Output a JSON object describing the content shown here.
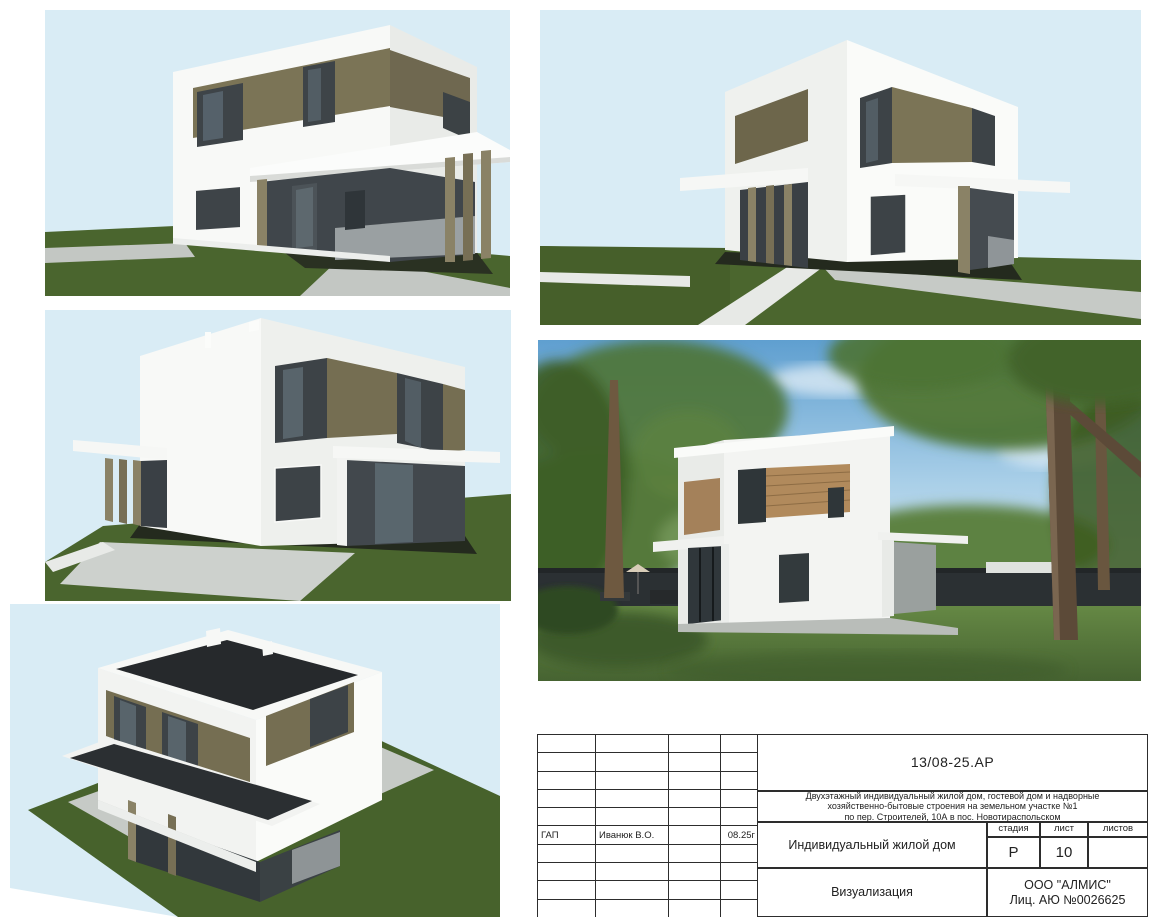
{
  "title_block": {
    "doc_code": "13/08-25.АР",
    "description": {
      "line1": "Двухэтажный индивидуальный жилой дом, гостевой дом и надворные",
      "line2": "хозяйственно-бытовые строения на земельном участке №1",
      "line3": "по пер. Строителей, 10А в пос. Новотираспольском"
    },
    "signature_row": {
      "role": "ГАП",
      "name": "Иванюк В.О.",
      "date": "08.25г"
    },
    "object_name": "Индивидуальный жилой дом",
    "stage_label": "стадия",
    "stage_value": "Р",
    "sheet_label": "лист",
    "sheet_value": "10",
    "sheets_label": "листов",
    "sheets_value": "",
    "view_title": "Визуализация",
    "company_name": "ООО \"АЛМИС\"",
    "company_license": "Лиц.  АЮ  №0026625"
  },
  "colors": {
    "paper": "#ffffff",
    "sky": "#d9ecf5",
    "grass": "#4a652e",
    "path_gray": "#c3c7c3",
    "house_white": "#f8f9f7",
    "wood_cladding": "#7b7456",
    "window_dark": "#3d4347",
    "recess_dark": "#40464b",
    "roof_dark": "#26292c",
    "photo_sky": "#6fa8d6",
    "photo_grass": "#5a7d3e",
    "fence_dark": "#2b3033",
    "photo_wood": "#b18a5c",
    "line": "#2d2d2d"
  }
}
